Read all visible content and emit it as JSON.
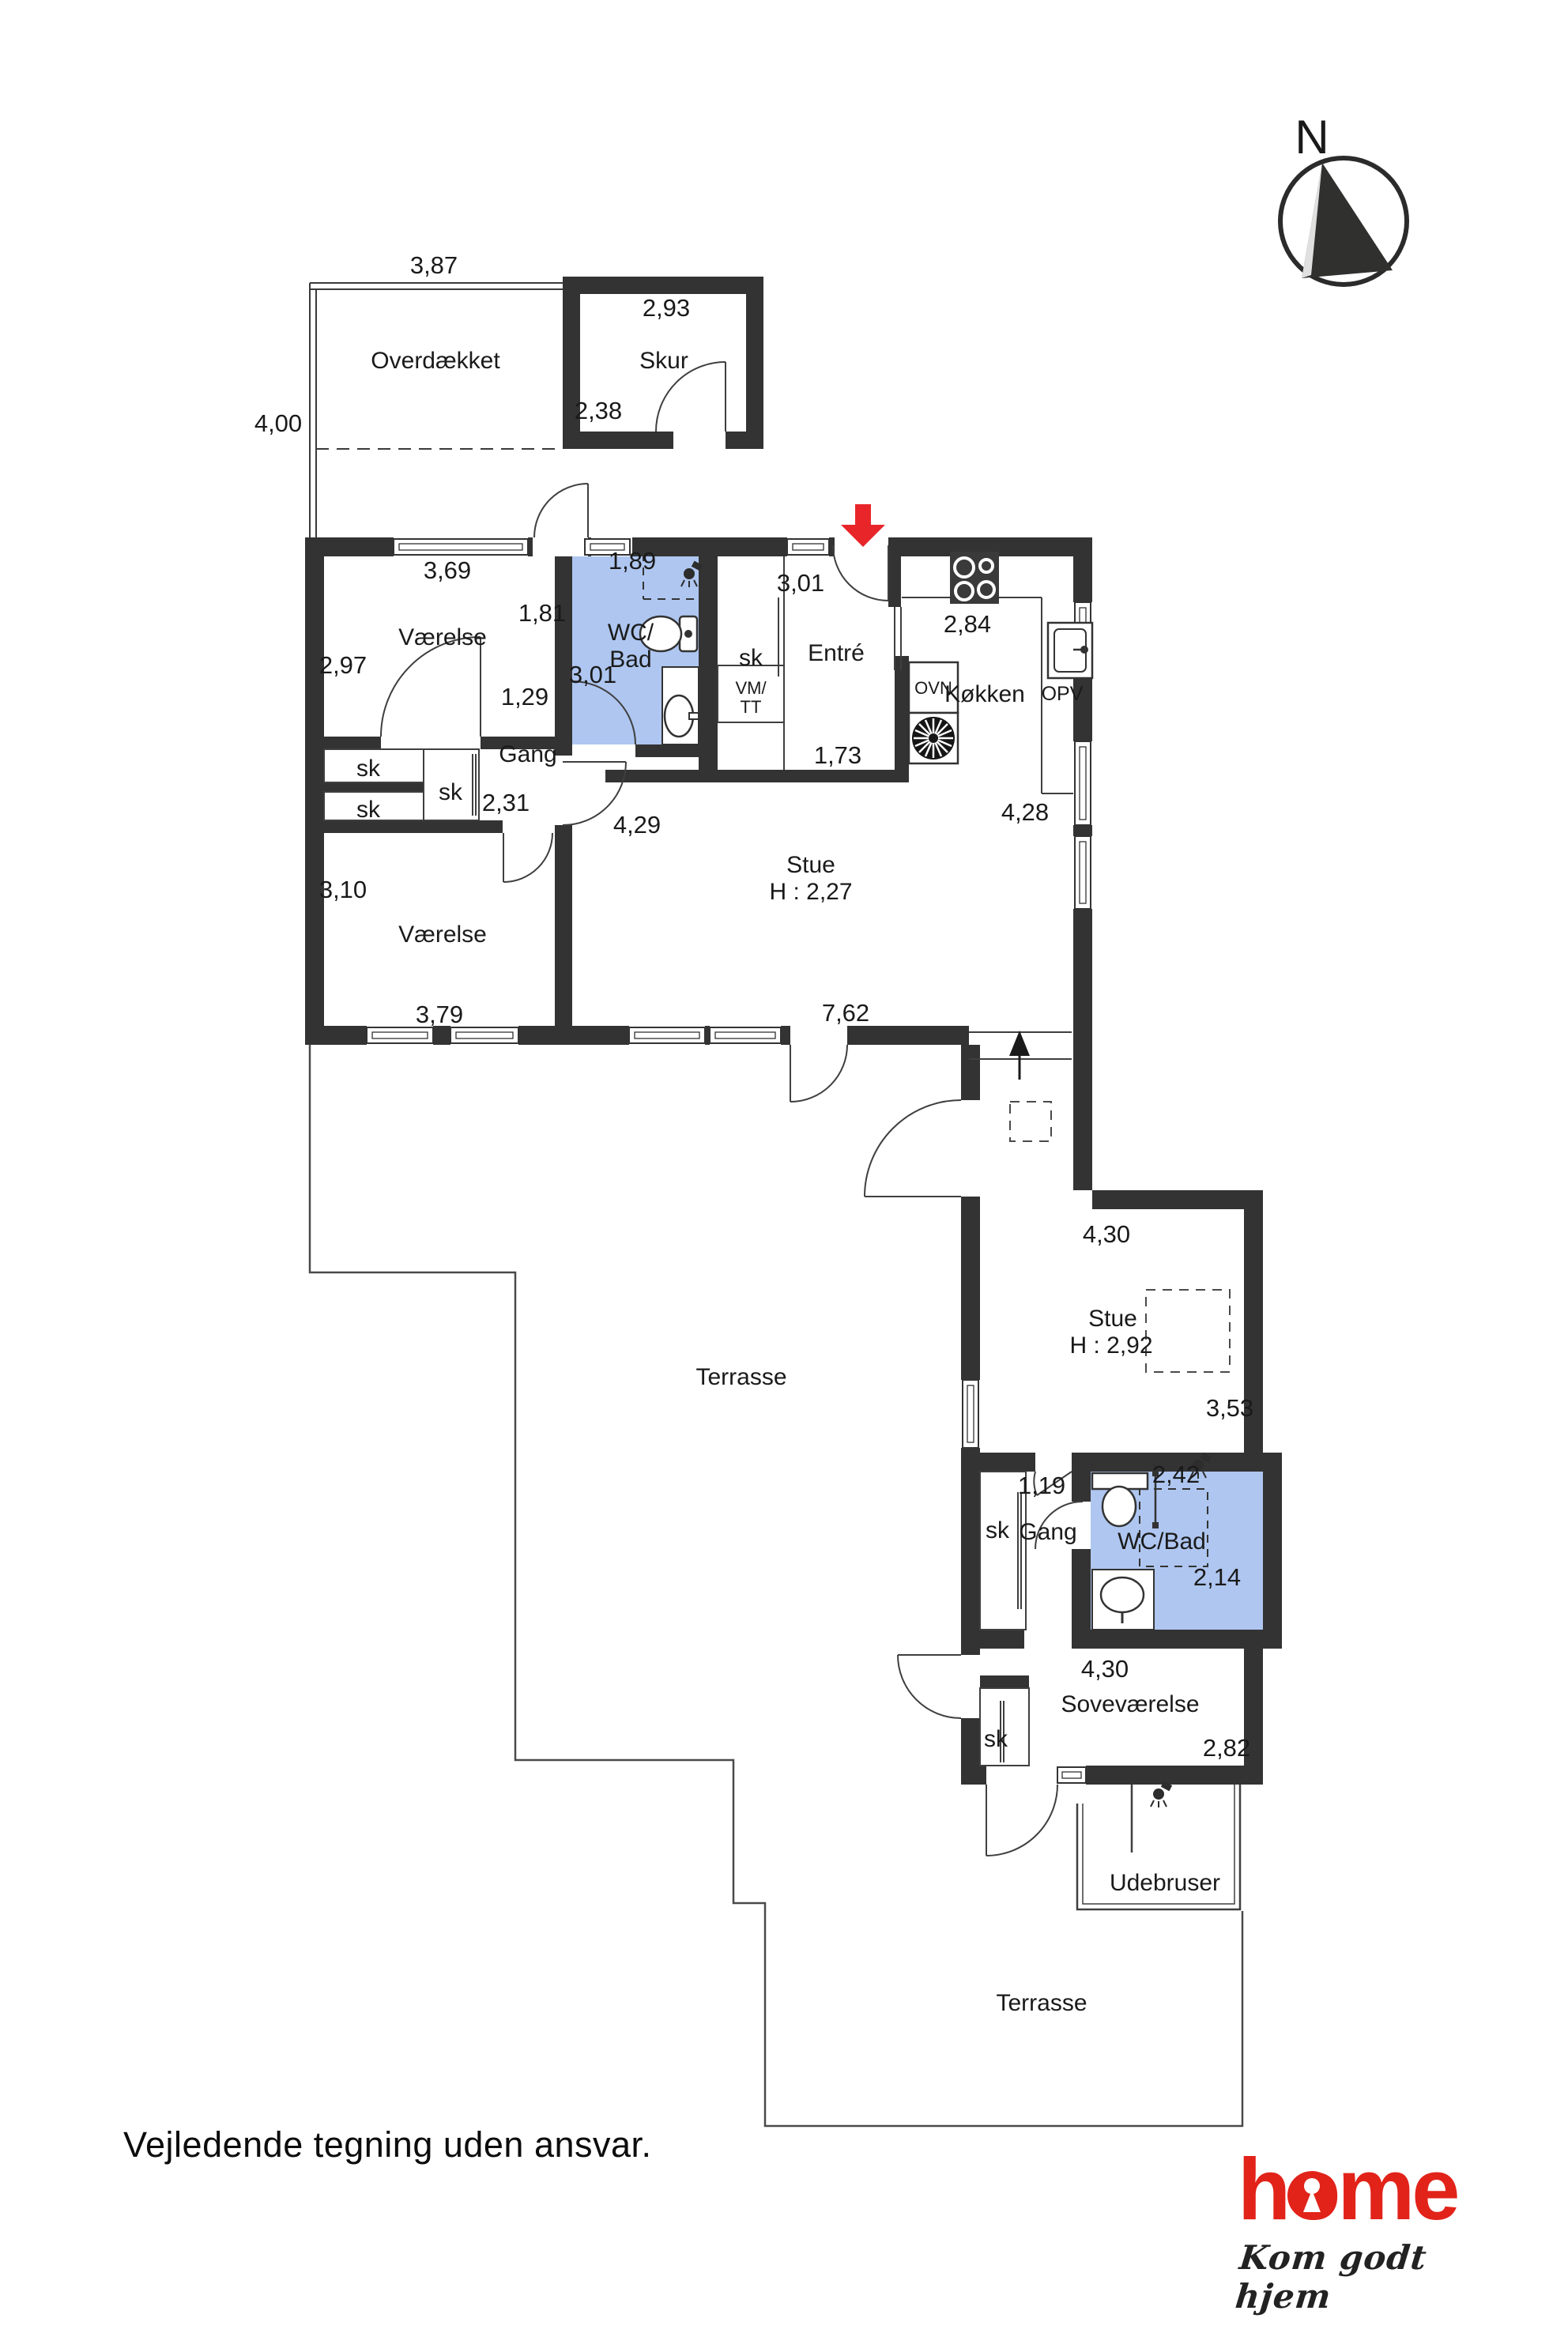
{
  "colors": {
    "wall": "#333333",
    "bath_fill": "#aec6f0",
    "entrance_arrow": "#e8262a",
    "logo_red": "#e2231a"
  },
  "compass": {
    "label": "N"
  },
  "outdoor": {
    "overdaekket": {
      "name": "Overdækket",
      "width": "3,87",
      "depth": "4,00"
    },
    "skur": {
      "name": "Skur",
      "width": "2,93",
      "depth": "2,38"
    },
    "terrasse_upper": {
      "name": "Terrasse"
    },
    "terrasse_lower": {
      "name": "Terrasse"
    },
    "udebruser": {
      "name": "Udebruser"
    }
  },
  "main_house": {
    "vaerelse_1": {
      "name": "Værelse",
      "width": "3,69",
      "depth": "2,97"
    },
    "wc_bad": {
      "line1": "WC/",
      "line2": "Bad",
      "width": "1,89",
      "depth": "3,01"
    },
    "gang": {
      "name": "Gang",
      "d1": "1,29",
      "d2": "1,81",
      "d3": "2,31",
      "d4": "4,29"
    },
    "closet": "sk",
    "vm_tt": {
      "line1": "VM/",
      "line2": "TT"
    },
    "entre": {
      "name": "Entré",
      "depth": "3,01",
      "width": "1,73"
    },
    "koekken": {
      "name": "Køkken",
      "width": "2,84",
      "counter": "4,28",
      "oven": "OVN",
      "dishwasher": "OPV"
    },
    "stue": {
      "name": "Stue",
      "ceiling": "H : 2,27",
      "width": "7,62"
    },
    "vaerelse_2": {
      "name": "Værelse",
      "width": "3,79",
      "depth": "3,10"
    }
  },
  "annex": {
    "stue": {
      "name": "Stue",
      "ceiling": "H : 2,92",
      "width": "4,30",
      "depth": "3,53"
    },
    "gang": {
      "name": "Gang",
      "width": "1,19"
    },
    "wc_bad": {
      "name": "WC/Bad",
      "width": "2,42",
      "depth": "2,14",
      "width2": "4,30"
    },
    "sovevaerelse": {
      "name": "Soveværelse",
      "depth": "2,82"
    },
    "closet": "sk"
  },
  "footer": {
    "disclaimer": "Vejledende tegning uden ansvar."
  },
  "logo": {
    "brand": "home",
    "tagline": "Kom godt hjem"
  }
}
